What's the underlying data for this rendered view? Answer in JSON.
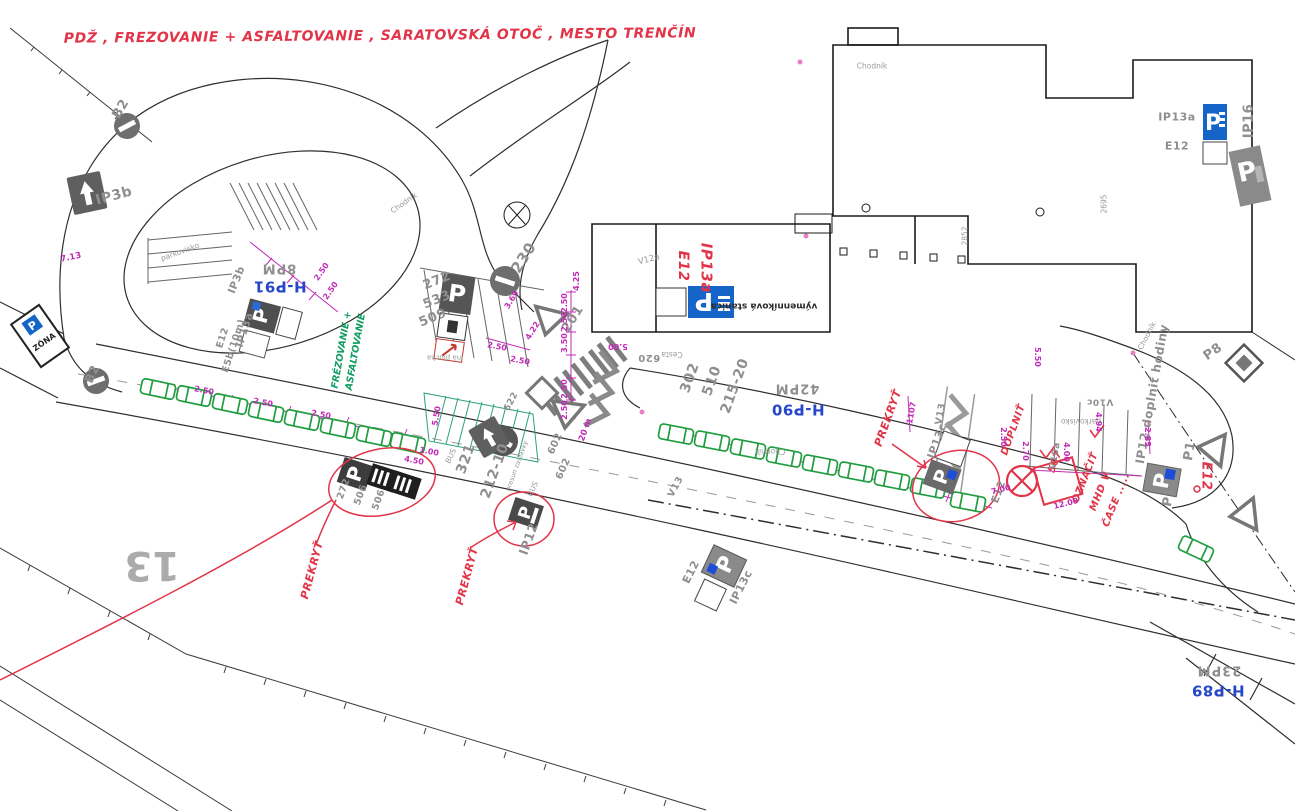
{
  "annotations": {
    "title": "PDŽ , FREZOVANIE + ASFALTOVANIE , SARATOVSKÁ OTOČ , MESTO TRENČÍN",
    "prekryt": "PREKRYŤ",
    "doplnit": "DOPLNIŤ",
    "oznacit_line1": "OZNAČIŤ",
    "oznacit_line2": "MHD V",
    "oznacit_line3": "ČASE .....",
    "ip13a_red": "IP13a",
    "e12_red": "E12",
    "n507": "507",
    "frez_line1": "FRÉZOVANIE +",
    "frez_line2": "ASFALTOVANIE",
    "ip12_doplnit": "IP12 doplniť hodiny"
  },
  "parking_headers": {
    "hp91": "H-P91",
    "hp91_cap": "8PM",
    "hp90": "H-P90",
    "hp90_cap": "42PM",
    "hp89": "H-P89",
    "hp89_cap": "23PM"
  },
  "sign_codes": {
    "ip3b": "IP3b",
    "b2": "B2",
    "zona": "ZÓNA",
    "ip13a": "IP13a",
    "e5b": "E5b(10m)",
    "e12": "E12",
    "ip13c": "IP13c",
    "ip12": "IP12",
    "ip16": "IP16",
    "p1": "P1",
    "p8": "P8",
    "v12a": "V12a",
    "v13": "V13",
    "v10a": "V10a",
    "v10c": "V10c"
  },
  "plan_numbers": {
    "n230": "230",
    "n272": "272",
    "n533": "533",
    "n509": "509",
    "n201": "201",
    "n302": "302",
    "n510": "510",
    "n215_20": "215-20",
    "n321": "321",
    "n212_10": "212-10",
    "n602": "602",
    "n622": "622",
    "n620": "620",
    "n506": "506",
    "n2852": "2852",
    "n2695": "2695",
    "parcel_13": "13"
  },
  "place_labels": {
    "chodnik": "Chodník",
    "cesta": "Cesta",
    "vymennikova_stanica": "výmenníková stanica",
    "parkovisko": "parkovisko",
    "ina_plocha": "iná plocha",
    "bus": "BUS",
    "presun_zastavky": "presun zastávky"
  },
  "dimensions": {
    "d100": "1.00",
    "d250": "2.50",
    "d270": "2.70",
    "d285": "2.85",
    "d350": "3.50",
    "d369": "3.69",
    "d400": "4.00",
    "d422": "4.22",
    "d425": "4.25",
    "d450": "4.50",
    "d494": "4.94",
    "d500": "5.00",
    "d550": "5.50",
    "d700": "7.00",
    "d713": "7.13",
    "d1107": "1107",
    "d1200": "12.00",
    "d20m": "20 m"
  },
  "icons": {
    "p_glyph": "P"
  },
  "colors": {
    "red_ink": "#e23448",
    "green_ink": "#0f9d62",
    "blue_label": "#2547c8",
    "magenta_dim": "#c12bb5",
    "sign_blue": "#1565c8",
    "car_green": "#1f9d3f",
    "teal_hatch": "#2aa17e"
  }
}
